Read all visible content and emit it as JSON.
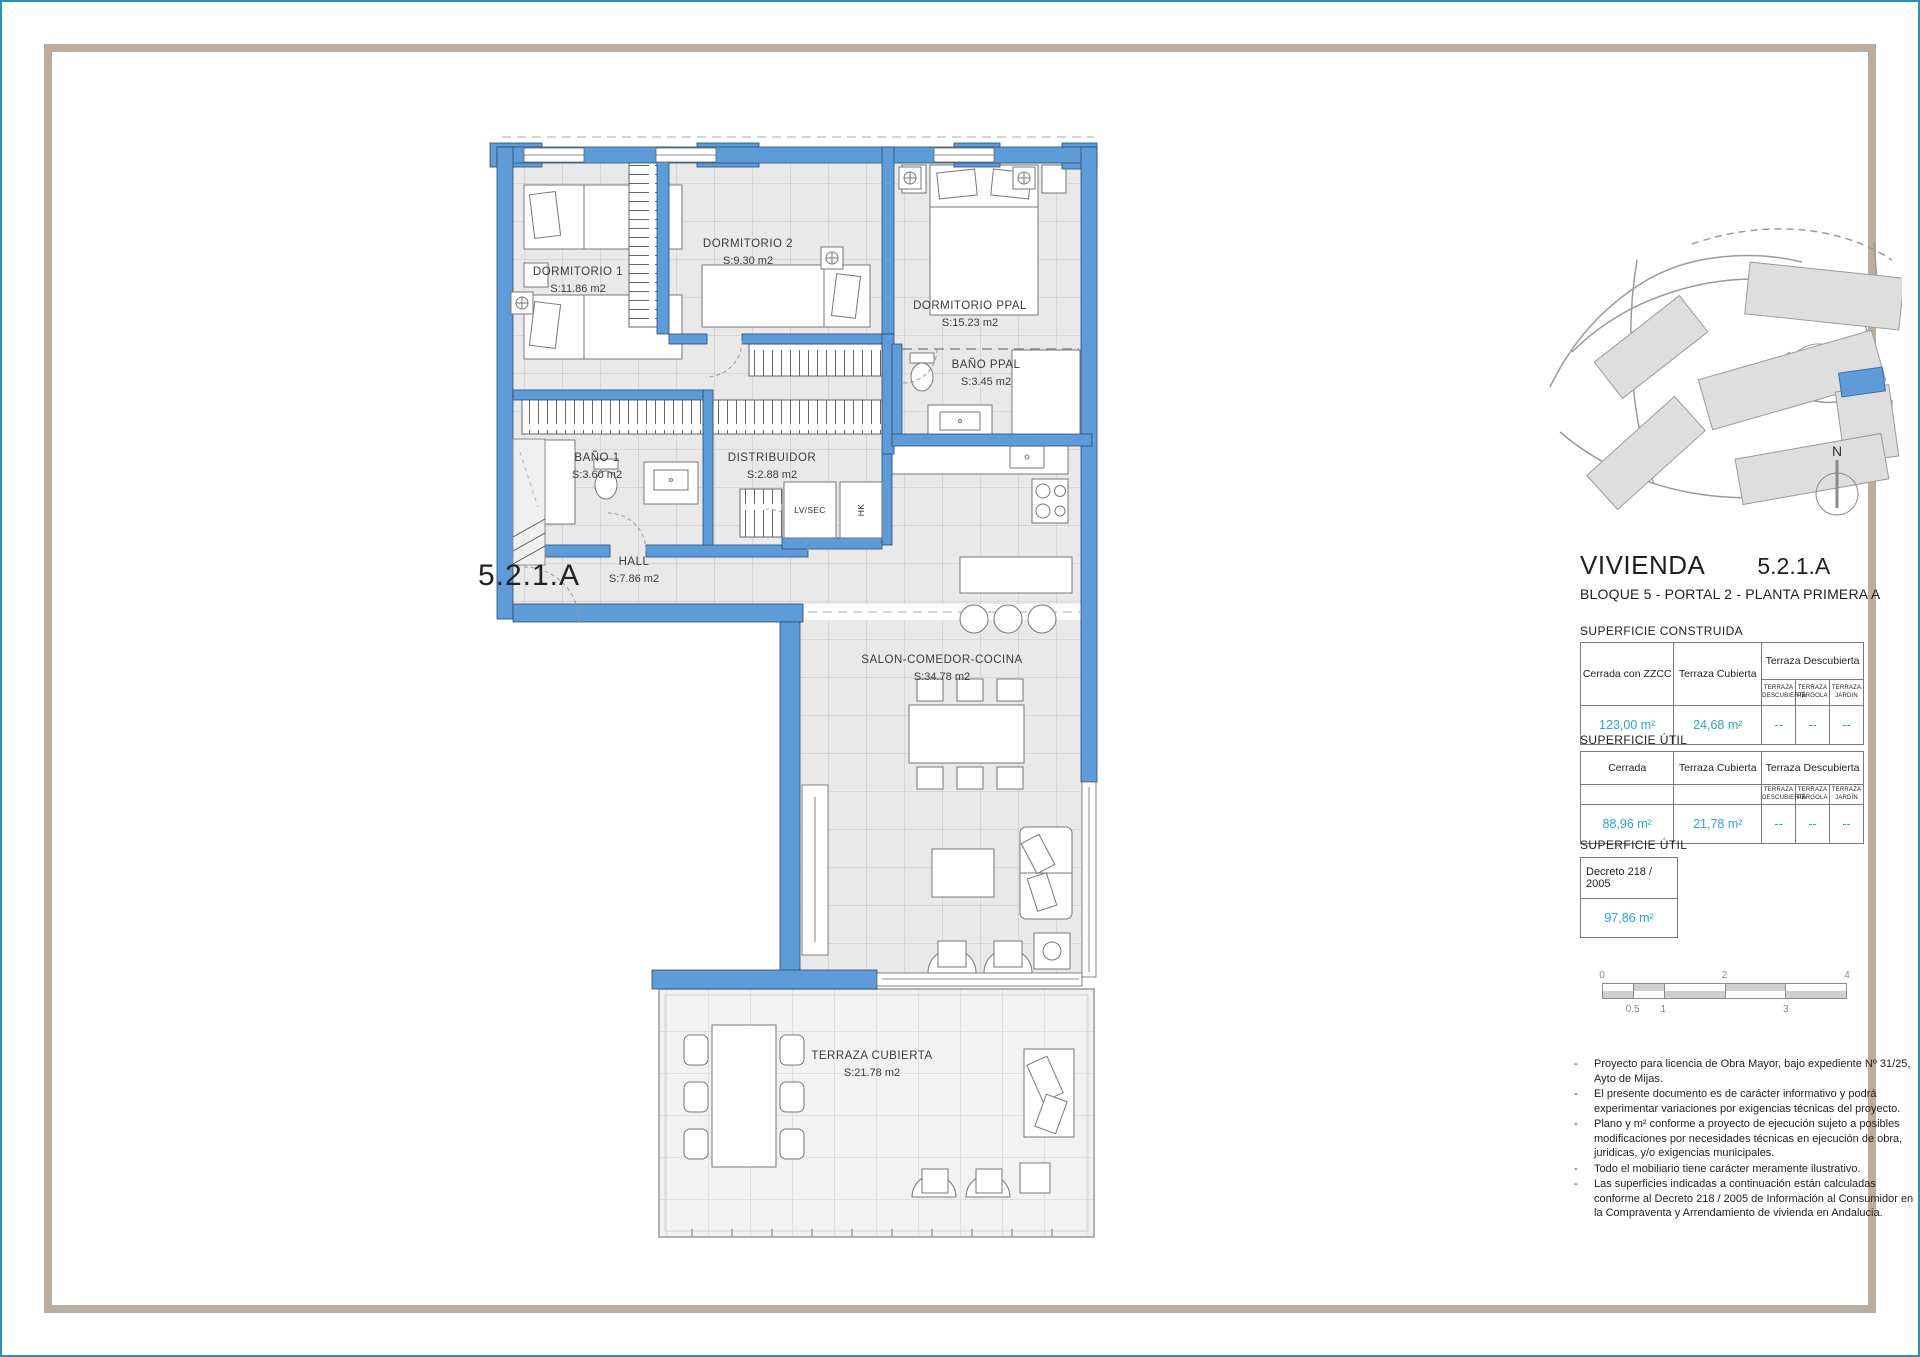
{
  "colors": {
    "wall_blue": "#5d9cd8",
    "wall_outline": "#2b4a73",
    "floor_gray": "#e9e9e9",
    "terrace_floor": "#f3f3f3",
    "value_blue": "#2ba3d4",
    "frame_tan": "#bcae9e",
    "page_border_teal": "#2d93ac"
  },
  "plan": {
    "unit_label": "5.2.1.A",
    "rooms": [
      {
        "name": "DORMITORIO 1",
        "area": "S:11.86 m2"
      },
      {
        "name": "DORMITORIO 2",
        "area": "S:9.30 m2"
      },
      {
        "name": "DORMITORIO PPAL",
        "area": "S:15.23 m2"
      },
      {
        "name": "BAÑO PPAL",
        "area": "S:3.45 m2"
      },
      {
        "name": "BAÑO 1",
        "area": "S:3.60 m2"
      },
      {
        "name": "DISTRIBUIDOR",
        "area": "S:2.88 m2"
      },
      {
        "name": "HALL",
        "area": "S:7.86 m2"
      },
      {
        "name": "SALON-COMEDOR-COCINA",
        "area": "S:34.78 m2"
      },
      {
        "name": "TERRAZA CUBIERTA",
        "area": "S:21.78 m2"
      }
    ],
    "utility_labels": {
      "lvsec": "LV/SEC",
      "hk": "HK"
    }
  },
  "sidebar": {
    "north_label": "N",
    "title": "VIVIENDA",
    "title_unit": "5.2.1.A",
    "subtitle": "BLOQUE 5 - PORTAL 2 - PLANTA PRIMERA A",
    "table_construida": {
      "label": "SUPERFICIE CONSTRUIDA",
      "col1": "Cerrada con ZZCC",
      "col2": "Terraza Cubierta",
      "col3": "Terraza Descubierta",
      "sub": [
        "TERRAZA DESCUBIERTA",
        "TERRAZA PÉRGOLA",
        "TERRAZA JARDIN"
      ],
      "values": [
        "123,00 m²",
        "24,68 m²",
        "--",
        "--",
        "--"
      ]
    },
    "table_util": {
      "label": "SUPERFICIE ÚTIL",
      "col1": "Cerrada",
      "col2": "Terraza Cubierta",
      "col3": "Terraza Descubierta",
      "sub": [
        "TERRAZA DESCUBIERTA",
        "TERRAZA PÉRGOLA",
        "TERRAZA JARDÍN"
      ],
      "values": [
        "88,96 m²",
        "21,78 m²",
        "--",
        "--",
        "--"
      ]
    },
    "table_decreto": {
      "label": "SUPERFICIE ÚTIL",
      "header": "Decreto 218 / 2005",
      "value": "97,86 m²"
    },
    "scalebar": {
      "top_labels": [
        "0",
        "2",
        "4"
      ],
      "bottom_labels": [
        "0.5",
        "1",
        "3"
      ]
    },
    "notes": [
      "Proyecto para licencia de Obra Mayor, bajo expediente Nº 31/25, Ayto de Mijas.",
      "El presente documento es de carácter informativo y podrá experimentar variaciones por exigencias técnicas del proyecto.",
      "Plano y m² conforme a proyecto de ejecución sujeto a posibles modificaciones por necesidades técnicas en ejecución de obra, juridicas, y/o exigencias municipales.",
      "Todo el mobiliario tiene carácter meramente ilustrativo.",
      "Las superficies indicadas a continuación están calculadas conforme al Decreto 218 / 2005 de Información al Consumidor en la Compraventa y Arrendamiento de vivienda en Andalucia."
    ]
  }
}
